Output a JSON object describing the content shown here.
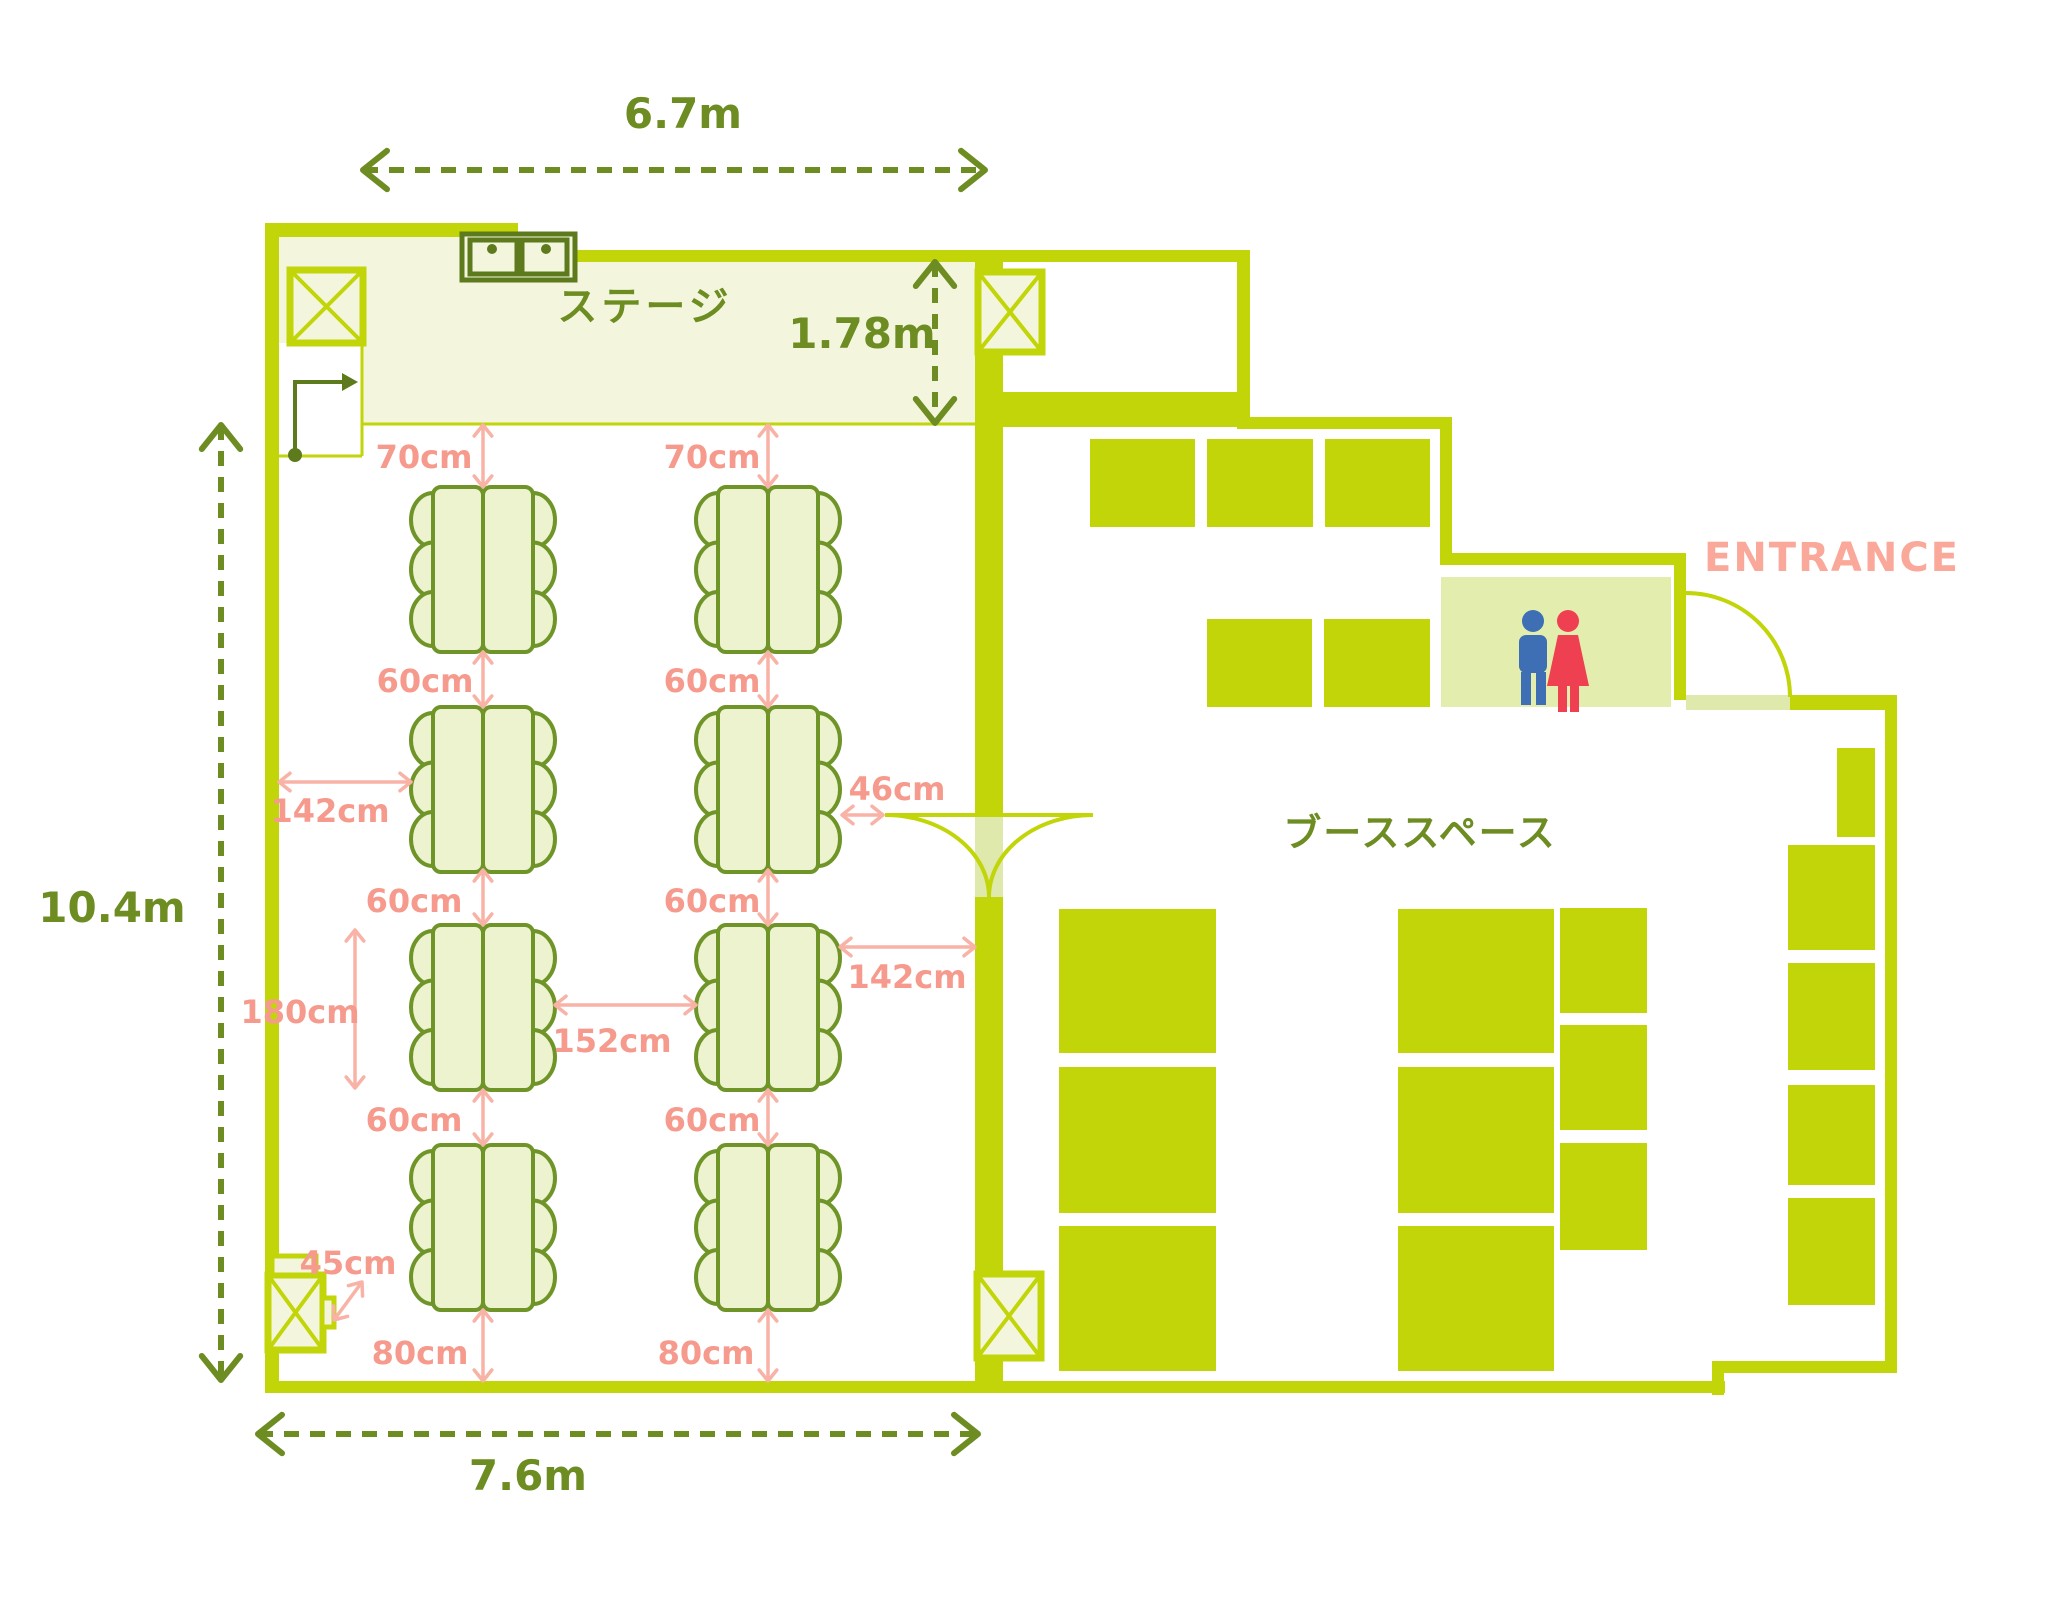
{
  "labels": {
    "stage": "ステージ",
    "booth": "ブーススペース",
    "entrance": "ENTRANCE"
  },
  "colors": {
    "lime": "#c1d508",
    "gap": "#dfe9ab",
    "pale": "#f3f6dd",
    "tablefill": "#edf2cf",
    "tablestroke": "#6f9428",
    "olive": "#6d8c21",
    "sinkstroke": "#5d7a1d",
    "salmon": "#f59a8c",
    "pink": "#f8b2a6",
    "entrance": "#f9a89a",
    "man": "#3e6eb4",
    "woman": "#ee4050",
    "restroom": "#e3edae"
  },
  "floor": {
    "walls": [
      [
        265,
        223,
        14,
        1170
      ],
      [
        265,
        223,
        253,
        14
      ],
      [
        505,
        223,
        13,
        39
      ],
      [
        505,
        250,
        745,
        12
      ],
      [
        1237,
        250,
        13,
        177
      ],
      [
        975,
        392,
        270,
        35
      ],
      [
        1237,
        417,
        215,
        12
      ],
      [
        1440,
        417,
        12,
        148
      ],
      [
        1440,
        553,
        246,
        12
      ],
      [
        1674,
        553,
        12,
        147
      ],
      [
        1790,
        695,
        107,
        15
      ],
      [
        1885,
        695,
        12,
        678
      ],
      [
        1722,
        1361,
        175,
        12
      ],
      [
        1712,
        1361,
        12,
        34
      ],
      [
        265,
        1381,
        1460,
        12
      ],
      [
        975,
        250,
        28,
        565
      ],
      [
        975,
        897,
        28,
        484
      ]
    ],
    "door_gaps": [
      [
        975,
        815,
        28,
        82
      ],
      [
        1686,
        695,
        104,
        15
      ]
    ],
    "stage_rects": [
      [
        279,
        237,
        226,
        188
      ],
      [
        505,
        262,
        470,
        163
      ]
    ],
    "pillars": [
      [
        290,
        270,
        73,
        73
      ],
      [
        978,
        272,
        64,
        80
      ],
      [
        977,
        1274,
        64,
        84
      ],
      [
        268,
        1275,
        55,
        75
      ]
    ],
    "booth_squares": [
      [
        1090,
        439,
        105,
        88
      ],
      [
        1207,
        439,
        106,
        88
      ],
      [
        1325,
        439,
        105,
        88
      ],
      [
        1207,
        619,
        105,
        88
      ],
      [
        1324,
        619,
        106,
        88
      ],
      [
        1059,
        909,
        157,
        144
      ],
      [
        1059,
        1067,
        157,
        146
      ],
      [
        1059,
        1226,
        157,
        145
      ],
      [
        1398,
        909,
        156,
        144
      ],
      [
        1398,
        1067,
        156,
        146
      ],
      [
        1398,
        1226,
        156,
        145
      ],
      [
        1560,
        908,
        87,
        105
      ],
      [
        1560,
        1025,
        87,
        105
      ],
      [
        1560,
        1143,
        87,
        107
      ],
      [
        1837,
        748,
        38,
        89
      ],
      [
        1788,
        845,
        87,
        105
      ],
      [
        1788,
        963,
        87,
        107
      ],
      [
        1788,
        1085,
        87,
        100
      ],
      [
        1788,
        1198,
        87,
        107
      ]
    ]
  },
  "seating": {
    "cols": [
      433,
      718
    ],
    "rows": [
      487,
      707,
      925,
      1145
    ],
    "table_w": 50,
    "table_h": 165,
    "chair": {
      "rx": 22,
      "ry": 27,
      "offsets": [
        33,
        82.5,
        132
      ]
    }
  },
  "dimensions": {
    "metric": [
      {
        "x1": 363,
        "y1": 170,
        "x2": 985,
        "y2": 170,
        "t": "6.7m",
        "lx": 683,
        "ly": 128
      },
      {
        "x1": 221,
        "y1": 425,
        "x2": 221,
        "y2": 1380,
        "t": "10.4m",
        "lx": 112,
        "ly": 922
      },
      {
        "x1": 258,
        "y1": 1434,
        "x2": 978,
        "y2": 1434,
        "t": "7.6m",
        "lx": 528,
        "ly": 1490
      },
      {
        "x1": 935,
        "y1": 262,
        "x2": 935,
        "y2": 423,
        "t": "1.78m",
        "lx": 862,
        "ly": 348
      }
    ],
    "clearance": [
      {
        "x1": 483,
        "y1": 425,
        "x2": 483,
        "y2": 487,
        "t": "70cm",
        "lx": 424,
        "ly": 468
      },
      {
        "x1": 768,
        "y1": 425,
        "x2": 768,
        "y2": 487,
        "t": "70cm",
        "lx": 712,
        "ly": 468
      },
      {
        "x1": 483,
        "y1": 652,
        "x2": 483,
        "y2": 707,
        "t": "60cm",
        "lx": 425,
        "ly": 692
      },
      {
        "x1": 768,
        "y1": 652,
        "x2": 768,
        "y2": 707,
        "t": "60cm",
        "lx": 712,
        "ly": 692
      },
      {
        "x1": 483,
        "y1": 870,
        "x2": 483,
        "y2": 925,
        "t": "60cm",
        "lx": 414,
        "ly": 912
      },
      {
        "x1": 768,
        "y1": 870,
        "x2": 768,
        "y2": 925,
        "t": "60cm",
        "lx": 712,
        "ly": 912
      },
      {
        "x1": 483,
        "y1": 1090,
        "x2": 483,
        "y2": 1145,
        "t": "60cm",
        "lx": 414,
        "ly": 1131
      },
      {
        "x1": 768,
        "y1": 1090,
        "x2": 768,
        "y2": 1145,
        "t": "60cm",
        "lx": 712,
        "ly": 1131
      },
      {
        "x1": 483,
        "y1": 1310,
        "x2": 483,
        "y2": 1381,
        "t": "80cm",
        "lx": 420,
        "ly": 1364
      },
      {
        "x1": 768,
        "y1": 1310,
        "x2": 768,
        "y2": 1381,
        "t": "80cm",
        "lx": 706,
        "ly": 1364
      },
      {
        "x1": 279,
        "y1": 782,
        "x2": 411,
        "y2": 782,
        "t": "142cm",
        "lx": 330,
        "ly": 822
      },
      {
        "x1": 840,
        "y1": 947,
        "x2": 975,
        "y2": 947,
        "t": "142cm",
        "lx": 907,
        "ly": 988
      },
      {
        "x1": 842,
        "y1": 815,
        "x2": 883,
        "y2": 815,
        "t": "46cm",
        "lx": 897,
        "ly": 800
      },
      {
        "x1": 555,
        "y1": 1005,
        "x2": 696,
        "y2": 1005,
        "t": "152cm",
        "lx": 612,
        "ly": 1052
      },
      {
        "x1": 355,
        "y1": 930,
        "x2": 355,
        "y2": 1088,
        "t": "180cm",
        "lx": 300,
        "ly": 1023
      },
      {
        "x1": 334,
        "y1": 1320,
        "x2": 362,
        "y2": 1282,
        "t": "45cm",
        "lx": 348,
        "ly": 1274
      }
    ]
  }
}
